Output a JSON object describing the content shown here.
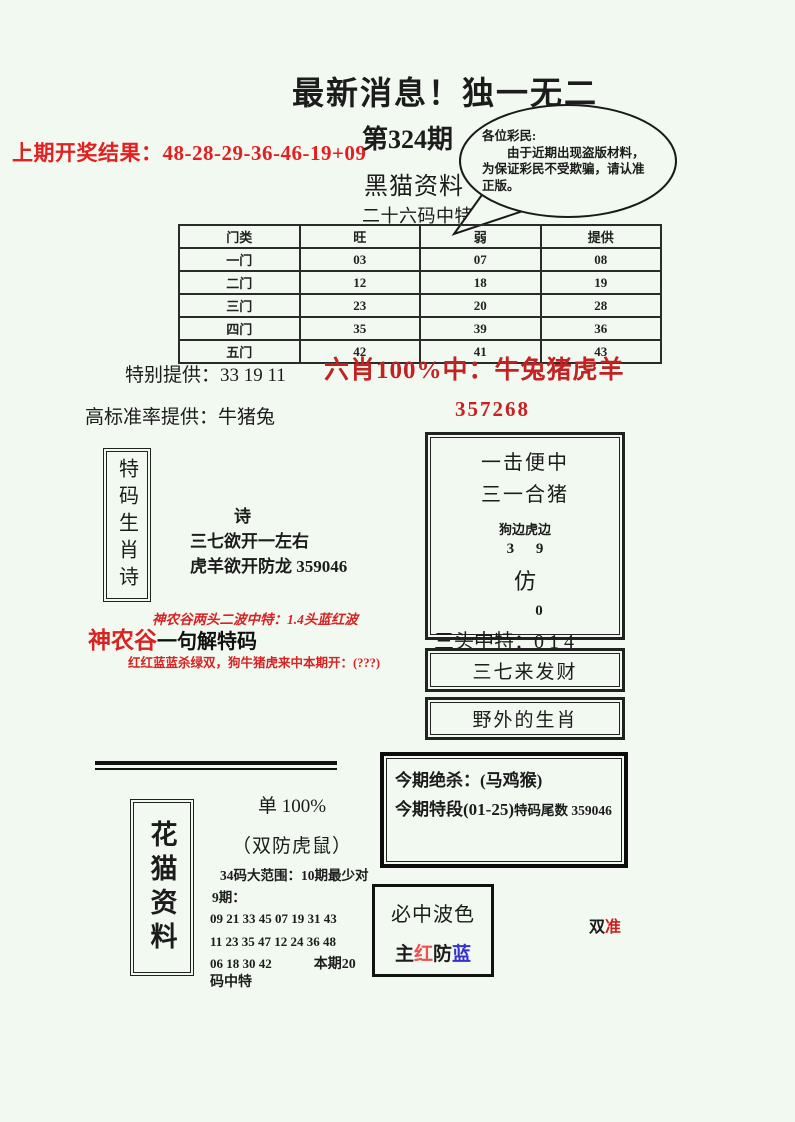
{
  "page": {
    "title": "最新消息！独一无二",
    "prev_result": "上期开奖结果：48-28-29-36-46-19+09",
    "issue": "第324期",
    "brand": "黑猫资料",
    "subtitle": "二十六码中特"
  },
  "bubble": {
    "line1": "各位彩民:",
    "line2": "由于近期出现盗版材料，为保证彩民不受欺骗，请认准正版。"
  },
  "table": {
    "headers": [
      "门类",
      "旺",
      "弱",
      "提供"
    ],
    "rows": [
      [
        "一门",
        "03",
        "07",
        "08"
      ],
      [
        "二门",
        "12",
        "18",
        "19"
      ],
      [
        "三门",
        "23",
        "20",
        "28"
      ],
      [
        "四门",
        "35",
        "39",
        "36"
      ],
      [
        "五门",
        "42",
        "41",
        "43"
      ]
    ]
  },
  "special": {
    "provide": "特别提供：33 19 11",
    "six_xiao": "六肖100%中：牛兔猪虎羊",
    "high_rate": "高标准率提供：牛猪兔",
    "code": "357268"
  },
  "poem_box": {
    "vertical_title": "特码生肖诗",
    "poem_title": "诗",
    "line1": "三七欲开一左右",
    "line2": "虎羊欲开防龙 359046"
  },
  "shennonggu": {
    "line1": "神农谷两头二波中特：1.4头蓝红波",
    "brand": "神农谷",
    "heading": "一句解特码",
    "line2": "红红蓝蓝杀绿双，狗牛猪虎来中本期开：(???)"
  },
  "hit_box": {
    "line1": "一击便中",
    "line2": "三一合猪",
    "line3": "狗边虎边",
    "line4": "3 9",
    "line5": "仿",
    "line6": "0",
    "line7": "三头中特：0 1 4"
  },
  "box_fortune": "三七来发财",
  "box_wild": "野外的生肖",
  "kill_box": {
    "line1": "今期绝杀：(马鸡猴)",
    "line2a": "今期特段(01-25)",
    "line2b": "特码尾数 359046"
  },
  "huamao": {
    "vertical_title": "花猫资料",
    "dan": "单 100%",
    "shuangfang": "（双防虎鼠）",
    "range": "34码大范围：10期最少对",
    "periods": "9期：",
    "nums1": "09 21 33 45 07 19 31 43",
    "nums2": "11 23 35 47 12 24 36 48",
    "nums3": "06 18 30 42",
    "benqi": "本期20",
    "zhongte": "码中特"
  },
  "bose": {
    "title": "必中波色",
    "zhu": "主",
    "hong": "红",
    "fang": "防",
    "lan": "蓝"
  },
  "accuracy": {
    "shuang": "双",
    "zhun": "准"
  },
  "colors": {
    "background": "#f2f9f1",
    "headline_red": "#e32020",
    "slogan_red": "#c32222",
    "hong_char": "#ef5050",
    "lan_char": "#3333cc"
  }
}
